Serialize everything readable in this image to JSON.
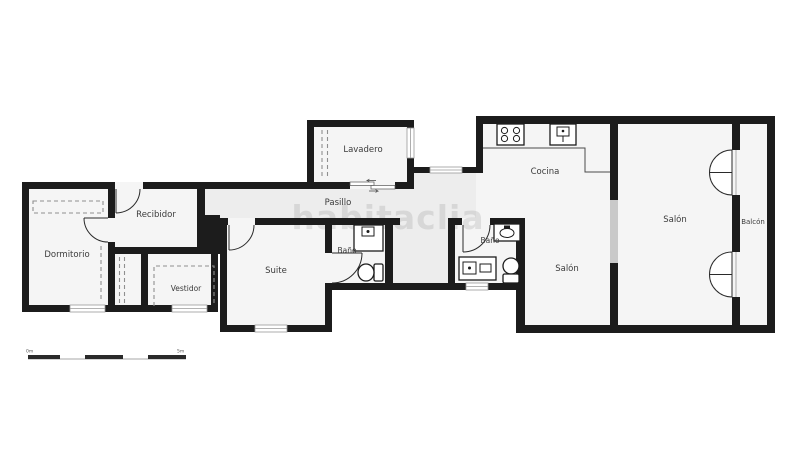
{
  "watermark": {
    "text": "habitaclia"
  },
  "colors": {
    "wall": "#1c1c1c",
    "room_floor": "#f5f5f5",
    "hall_floor": "#ededed",
    "glass_partition": "#c9c9c9",
    "background": "#ffffff"
  },
  "rooms": {
    "dormitorio": {
      "label": "Dormitorio"
    },
    "recibidor": {
      "label": "Recibidor"
    },
    "vestidor": {
      "label": "Vestidor"
    },
    "suite": {
      "label": "Suite"
    },
    "bano_suite": {
      "label": "Baño"
    },
    "pasillo": {
      "label": "Pasillo"
    },
    "lavadero": {
      "label": "Lavadero"
    },
    "cocina": {
      "label": "Cocina"
    },
    "bano_2": {
      "label": "Baño"
    },
    "salon_comedor": {
      "label": "Salón"
    },
    "salon": {
      "label": "Salón"
    },
    "balcon": {
      "label": "Balcón"
    }
  },
  "fixtures": [
    "stove-icon",
    "kitchen-sink-icon",
    "shower-icon",
    "toilet-icon",
    "washbasin-icon",
    "vanity-icon",
    "wardrobe-icon",
    "door-icon",
    "french-door-icon",
    "sliding-door-icon",
    "window-icon"
  ],
  "scale_bar": {
    "start": "0m",
    "end": "5m"
  }
}
